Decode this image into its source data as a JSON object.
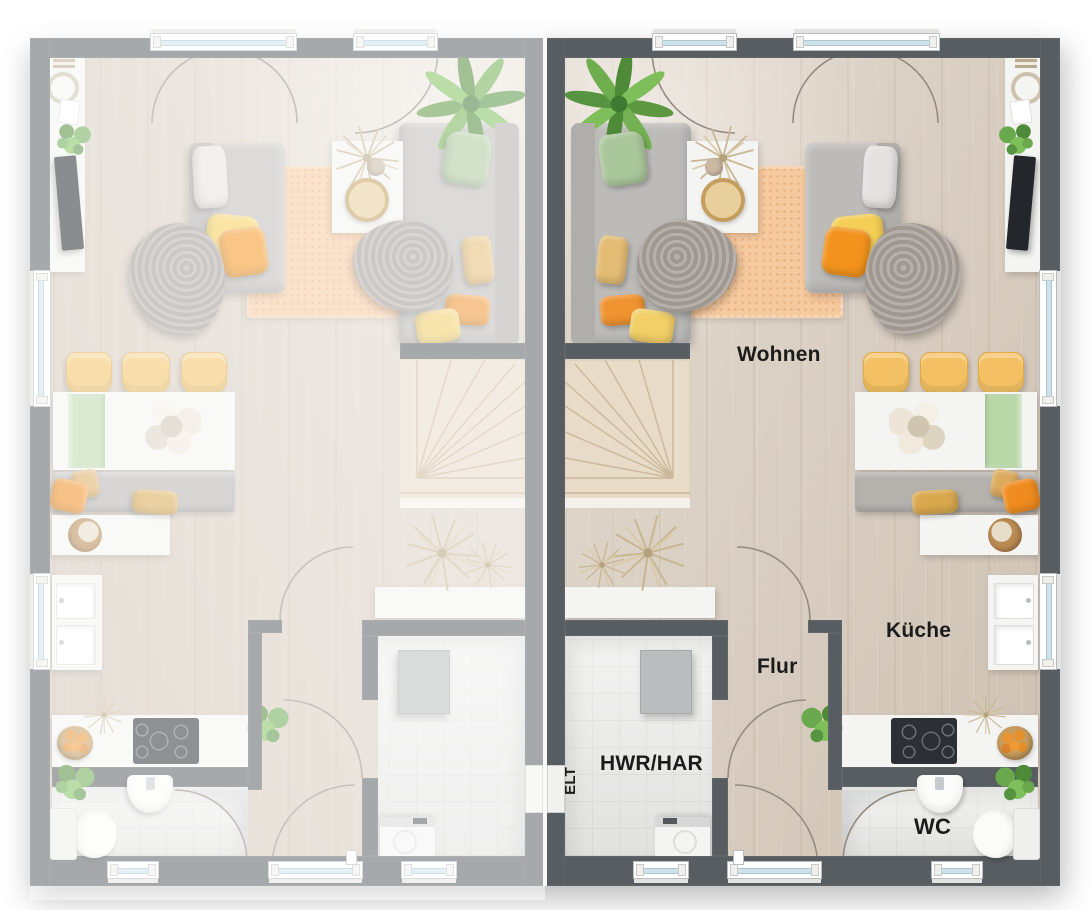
{
  "labels": {
    "wohnen": "Wohnen",
    "kueche": "Küche",
    "flur": "Flur",
    "hwr_har": "HWR/HAR",
    "elt": "ELT",
    "wc": "WC"
  },
  "colors": {
    "wall_dark": "#585d61",
    "wall_light_faded": "#a5a6a8",
    "floor_wood": "#d9ccbd",
    "tile": "#e8e9e7",
    "rug_peach": "#f6c99e",
    "stairs_wood": "#e8dcc9",
    "accent_orange": "#f3931d",
    "accent_yellow": "#f5ce55",
    "accent_green": "#aac79b",
    "label_text": "#1b1b1b",
    "window_glass": "#cfe2ea"
  }
}
